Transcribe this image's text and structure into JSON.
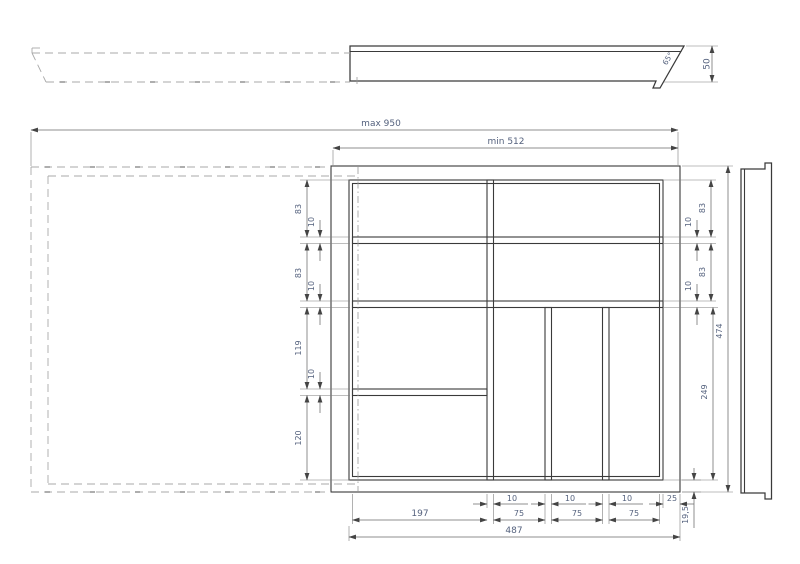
{
  "colors": {
    "background": "#ffffff",
    "geometry_line": "#3a3a3a",
    "dimension_line": "#6a6a6a",
    "dimension_text": "#55627e",
    "hidden_line": "#a8a8a8"
  },
  "side_view": {
    "height": "50",
    "front_angle": "65°"
  },
  "plan_view": {
    "max_width": "max 950",
    "min_width": "min 512",
    "left_chain": [
      "83",
      "10",
      "83",
      "10",
      "119",
      "10",
      "120"
    ],
    "right_chain": {
      "gap_top": "10",
      "compartment_top": "83",
      "gap_mid": "10",
      "compartment_mid": "83",
      "lower_section": "249",
      "total_depth": "474"
    },
    "bottom_chain": {
      "divider_1": "10",
      "divider_2": "10",
      "divider_3": "10",
      "side_wall": "25",
      "compartment_left": "197",
      "slot_1": "75",
      "slot_2": "75",
      "slot_3": "75",
      "rim": "19,5",
      "total_width": "487"
    }
  }
}
